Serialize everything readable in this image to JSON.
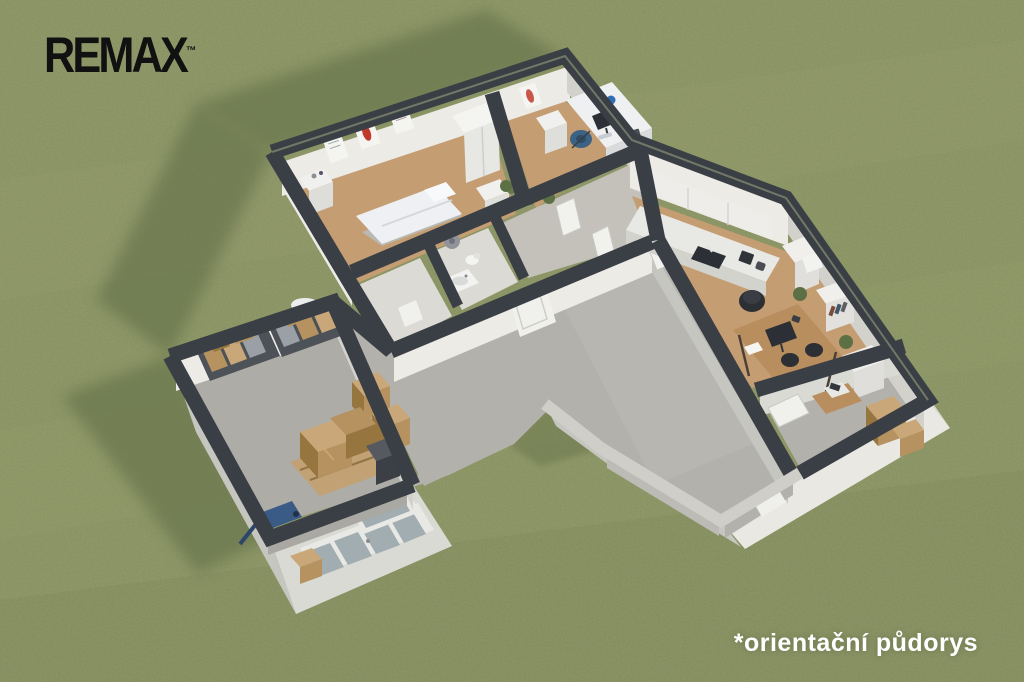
{
  "brand": {
    "logo_text": "REMAX",
    "logo_trademark": "™"
  },
  "caption": {
    "text": "*orientační půdorys"
  },
  "colors": {
    "grass": "#879060",
    "grassLight": "#95996a",
    "grassShadow": "#5f6c45",
    "wallTop": "#3a3f45",
    "wallTopDark": "#30353b",
    "wallTopLight": "#cfcec8",
    "wallWhiteLit": "#e9e8e3",
    "wallWhite": "#dadad4",
    "wallWhiteShade": "#c6c6c0",
    "innerFaceLit": "#ecebe6",
    "innerFaceShade": "#d2d1cc",
    "floorWood": "#c59d72",
    "floorWoodDark": "#b38a60",
    "floorConcrete": "#b3b1ab",
    "floorConcreteLight": "#c3c1ba",
    "floorWarehouse": "#aeaca6",
    "floorTile": "#dcdad4",
    "boxBrown": "#b5925f",
    "boxBrownLight": "#c9a778",
    "boxBrownDark": "#97753f",
    "palletWood": "#c2a274",
    "steelShelf": "#4d5258",
    "chairBlue": "#3d6384",
    "accentBlue": "#2f6fb3",
    "jackBlue": "#3a5b86",
    "plantGreen": "#5d7045",
    "glass": "#a2adb1",
    "deskWood": "#b98e5f",
    "darkDevice": "#2c3036",
    "posterRed": "#c0392b",
    "logo": "#111111",
    "caption": "#ffffff"
  },
  "rooms": [
    "examination-room",
    "doctor-office",
    "corridor",
    "bathroom",
    "storage-nook",
    "kitchen-office",
    "copy-room",
    "warehouse",
    "hall"
  ]
}
